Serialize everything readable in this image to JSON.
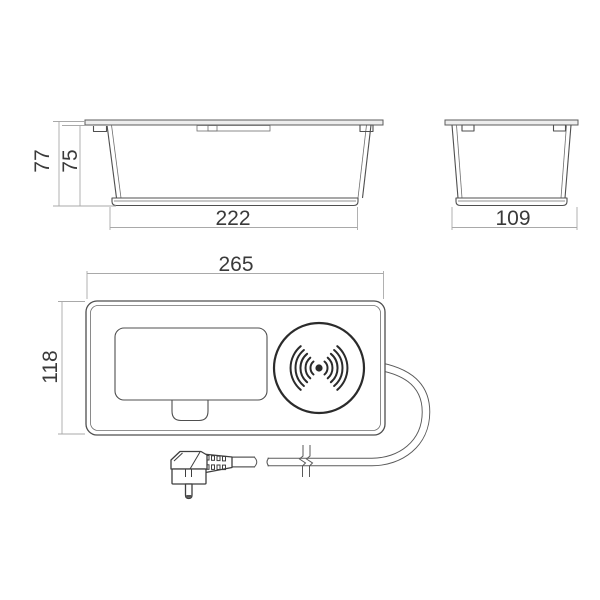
{
  "drawing": {
    "front_elevation": {
      "dim_overall_height": "77",
      "dim_body_height": "75",
      "dim_body_width": "222"
    },
    "side_elevation": {
      "dim_body_depth": "109"
    },
    "top_plan": {
      "dim_overall_width": "265",
      "dim_overall_depth": "118"
    }
  },
  "icons": {
    "wireless_charging": "wireless-charging-icon",
    "power_plug": "schuko-plug-icon",
    "cable_break": "cable-break-mark-icon"
  },
  "colors": {
    "background": "#ffffff",
    "outline": "#4f4f4f",
    "bold_outline": "#2b2b2b",
    "dimension_line": "#a9a9a9",
    "dimension_text": "#3a3a3a"
  }
}
